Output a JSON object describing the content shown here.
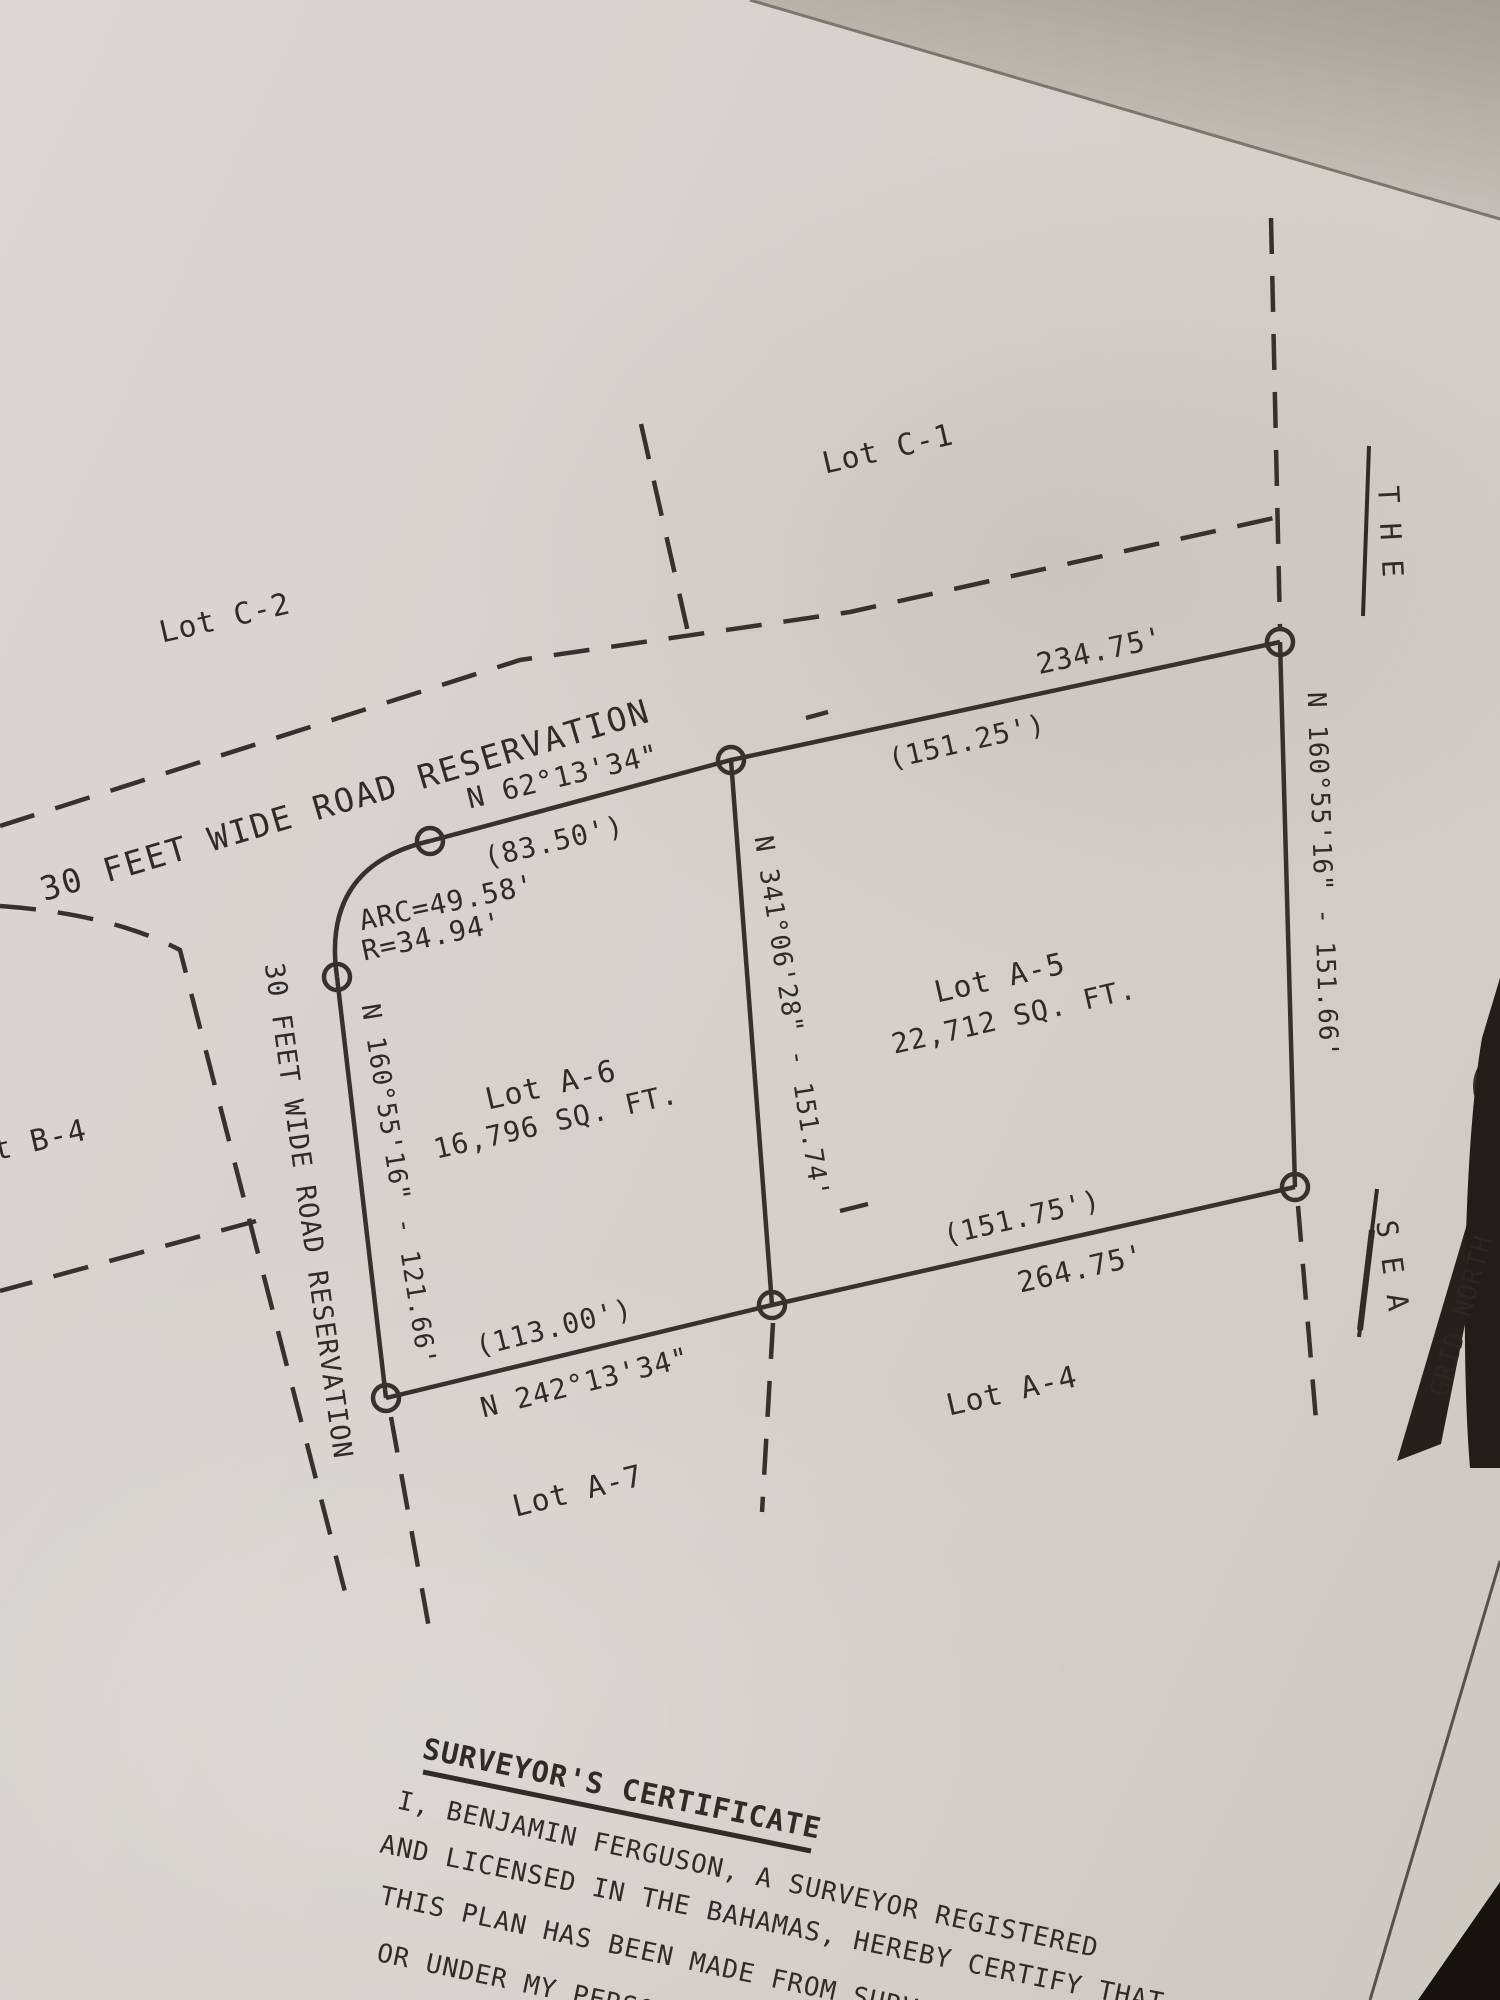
{
  "plan": {
    "lots": {
      "c1": "Lot C-1",
      "c2": "Lot C-2",
      "b4": "t B-4",
      "a4": "Lot A-4",
      "a5": "Lot A-5",
      "a5_area": "22,712 SQ. FT.",
      "a6": "Lot A-6",
      "a6_area": "16,796 SQ. FT.",
      "a7": "Lot A-7"
    },
    "roads": {
      "diagonal_label": "30 FEET WIDE ROAD RESERVATION",
      "vertical_label": "30 FEET WIDE ROAD RESERVATION"
    },
    "measurements": {
      "top_bearing": "N 62°13'34\"",
      "top_total": "234.75'",
      "top_seg_left": "(83.50')",
      "top_seg_right": "(151.25')",
      "arc": "ARC=49.58'",
      "radius": "R=34.94'",
      "mid_bearing": "N 341°06'28\" - 151.74'",
      "right_bearing": "N 160°55'16\" - 151.66'",
      "left_bearing": "N 160°55'16\" - 121.66'",
      "bottom_bearing": "N 242°13'34\"",
      "bottom_total": "264.75'",
      "bottom_seg_left": "(113.00')",
      "bottom_seg_right": "(151.75')"
    },
    "annotations": {
      "the": "T H E",
      "sea": "S E A",
      "grid_north": "GRID NORTH"
    },
    "certificate": {
      "title": "SURVEYOR'S CERTIFICATE",
      "line1": "I, BENJAMIN FERGUSON, A SURVEYOR REGISTERED",
      "line2": "AND LICENSED IN THE BAHAMAS, HEREBY CERTIFY THAT",
      "line3": "THIS PLAN HAS BEEN MADE FROM SURVEYS EXE",
      "line4": "OR UNDER MY PERSONAL SUPER"
    }
  }
}
